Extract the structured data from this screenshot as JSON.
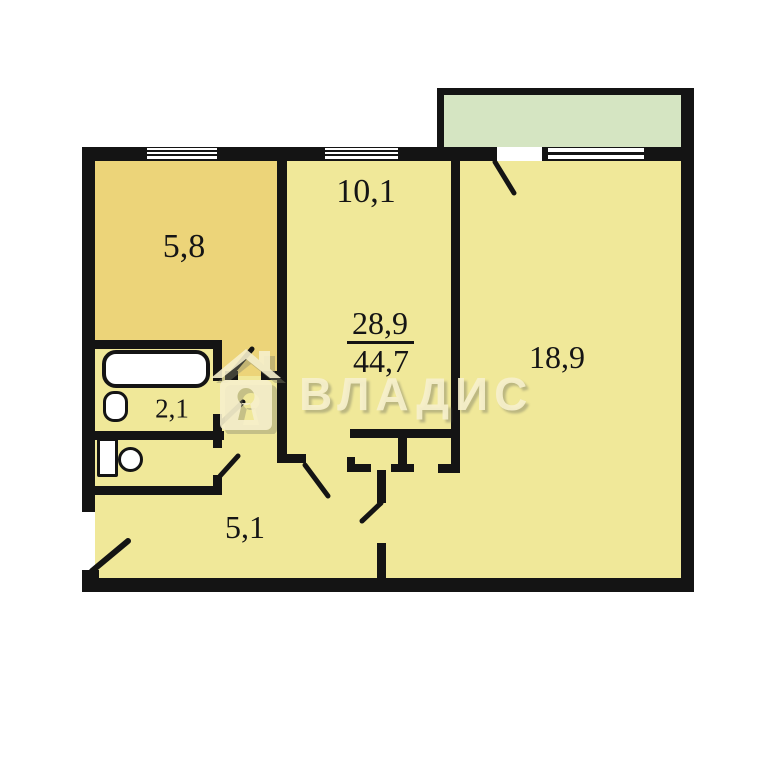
{
  "document_type": "apartment floor plan",
  "watermark": {
    "brand_text": "ВЛАДИС",
    "logo": "house-keyhole-icon",
    "color": "#f6f0cc"
  },
  "floorplan": {
    "labels": {
      "kitchen_area": "5,8",
      "room_small_area": "10,1",
      "room_large_area": "18,9",
      "bathroom_area": "2,1",
      "hallway_area": "5,1",
      "living_area_total": "28,9",
      "total_area": "44,7"
    },
    "rooms": [
      {
        "name": "kitchen",
        "area": "5,8"
      },
      {
        "name": "room-small",
        "area": "10,1"
      },
      {
        "name": "room-large",
        "area": "18,9"
      },
      {
        "name": "bathroom",
        "area": "2,1"
      },
      {
        "name": "hallway",
        "area": "5,1"
      },
      {
        "name": "toilet",
        "area": ""
      },
      {
        "name": "balcony",
        "area": ""
      }
    ],
    "area_fraction": {
      "numerator": "28,9",
      "denominator": "44,7"
    },
    "fixtures": [
      "bathtub",
      "sink",
      "toilet"
    ],
    "features": [
      "balcony",
      "two-windows",
      "balcony-door",
      "entrance-door",
      "built-in-closet"
    ],
    "colors": {
      "walls": "#141414",
      "kitchen_fill": "#ecd479",
      "room_fill": "#f0e899",
      "balcony_fill": "#d5e5c2",
      "fixture_fill": "#ffffff",
      "watermark": "#f6f0cc"
    }
  }
}
